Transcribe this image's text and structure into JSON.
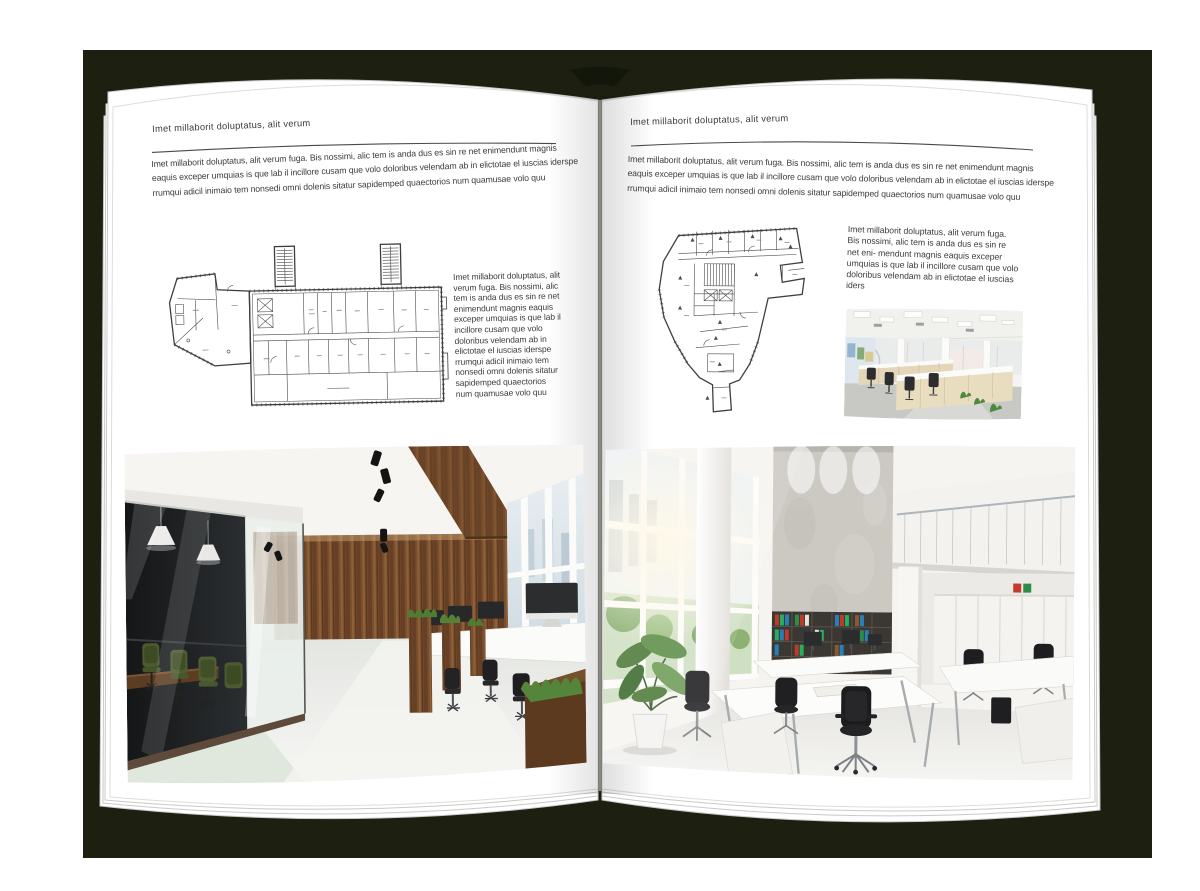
{
  "palette": {
    "backdrop": "#1d2011",
    "page": "#ffffff",
    "text": "#3d3d3f",
    "rule": "#4a4a4a"
  },
  "left_page": {
    "header": "Imet millaborit doluptatus, alit verum",
    "intro": "Imet millaborit doluptatus, alit verum fuga. Bis nossimi, alic tem is anda dus es sin re net enimendunt magnis eaquis exceper umquias is que lab il incillore cusam que volo doloribus velendam ab in elictotae el iuscias iderspe rrumqui adicil inimaio tem nonsedi omni dolenis sitatur sapidemped quaectorios num quamusae volo quu",
    "side_text": "Imet millaborit doluptatus, alit verum fuga. Bis nossimi, alic tem is anda dus es sin re net enimendunt magnis eaquis exceper umquias is que lab il incillore cusam que volo doloribus velendam ab in elictotae el iuscias iderspe rrumqui adicil inimaio tem nonsedi omni dolenis sitatur sapidemped quaectorios num quamusae volo quu",
    "floor_plan_name": "wide-building-floor-plan",
    "photo_name": "office-interior-wood-and-glass"
  },
  "right_page": {
    "header": "Imet millaborit doluptatus, alit verum",
    "intro": "Imet millaborit doluptatus, alit verum fuga. Bis nossimi, alic tem is anda dus es sin re net enimendunt magnis eaquis exceper umquias is que lab il incillore cusam que volo doloribus velendam ab in elictotae el iuscias iderspe rrumqui adicil inimaio tem nonsedi omni dolenis sitatur sapidemped quaectorios num quamusae volo quu",
    "side_text": "Imet millaborit doluptatus, alit verum fuga. Bis nossimi, alic tem is anda dus es sin re net eni- mendunt magnis eaquis exceper umquias is que lab il incillore cusam que volo doloribus velendam ab in elictotae el iuscias iders",
    "floor_plan_name": "irregular-building-floor-plan",
    "small_photo_name": "open-office-workstations",
    "photo_name": "office-interior-atrium"
  }
}
